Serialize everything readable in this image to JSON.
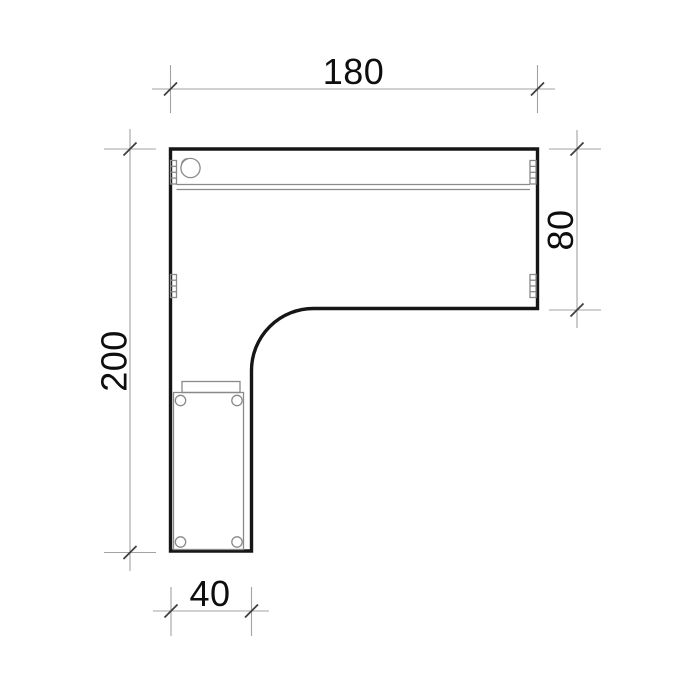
{
  "drawing": {
    "dimensions": {
      "top": "180",
      "right": "80",
      "left": "200",
      "bottom": "40"
    },
    "colors": {
      "background": "#ffffff",
      "outline": "#161616",
      "detail": "#8a8a8a",
      "dimension_line": "#a3a3a3",
      "tick": "#3f3f3f",
      "text": "#0e0e0e"
    }
  }
}
